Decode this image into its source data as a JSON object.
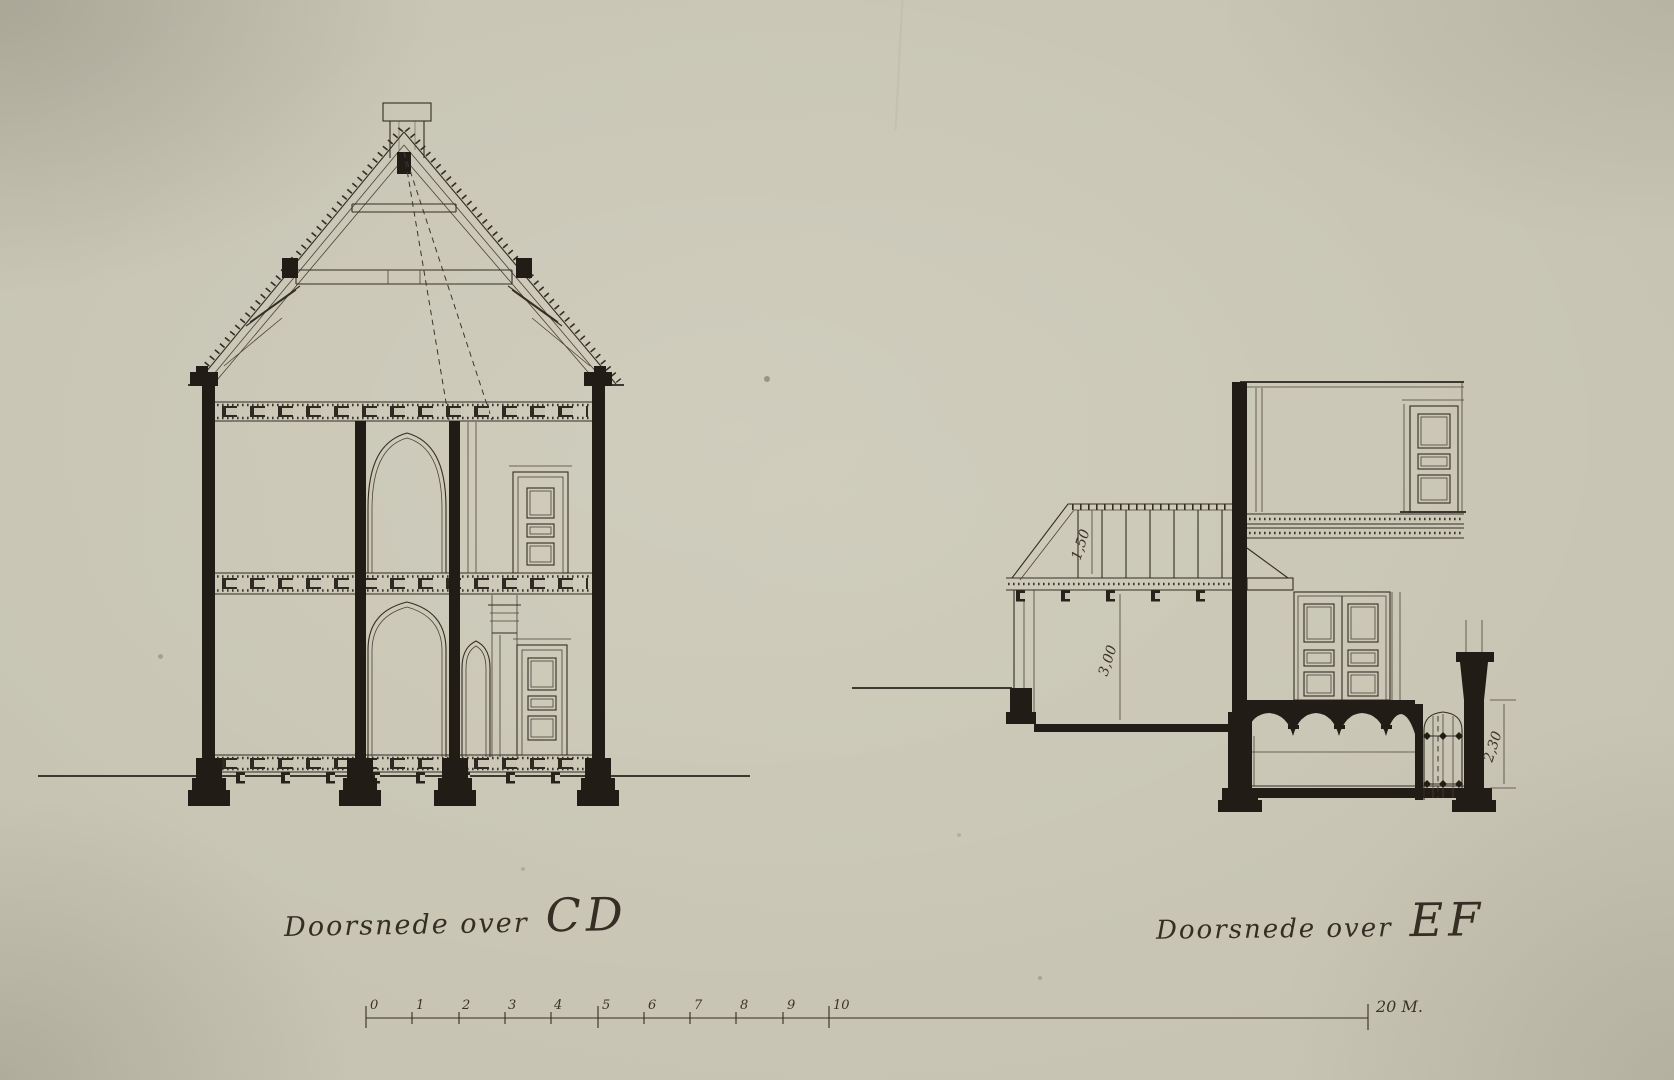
{
  "sheet": {
    "paper_color": "#c6c3b2",
    "ink_color": "#211c15",
    "line_color": "#332d24"
  },
  "sections": {
    "left": {
      "caption_prefix": "Doorsnede over",
      "caption_letters": "CD"
    },
    "right": {
      "caption_prefix": "Doorsnede over",
      "caption_letters": "EF",
      "dim_roof": "1,50",
      "dim_room": "3,00",
      "dim_basement": "2,30"
    }
  },
  "scale_bar": {
    "ticks": [
      "0",
      "1",
      "2",
      "3",
      "4",
      "5",
      "6",
      "7",
      "8",
      "9",
      "10"
    ],
    "end_label": "20 M."
  }
}
